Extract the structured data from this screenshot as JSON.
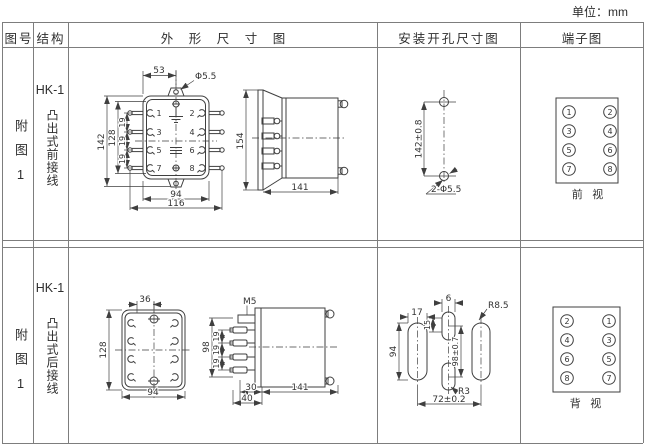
{
  "page": {
    "unit_label": "单位：mm"
  },
  "table": {
    "headers": {
      "figure": "图号",
      "structure": "结构",
      "outline": "外 形 尺 寸 图",
      "mounting": "安装开孔尺寸图",
      "terminal": "端子图"
    }
  },
  "rows": [
    {
      "figure_no": "附图1",
      "model": "HK-1",
      "wiring": "凸出式前接线",
      "front": {
        "dim_53": "53",
        "hole_label": "Φ5.5",
        "dim_142": "142",
        "dim_128": "128",
        "dim_19a": "19",
        "dim_19b": "19",
        "dim_19c": "19",
        "dim_94": "94",
        "dim_116": "116",
        "terminals": [
          "1",
          "2",
          "3",
          "4",
          "5",
          "6",
          "7",
          "8"
        ]
      },
      "side": {
        "dim_154": "154",
        "dim_141": "141"
      },
      "mounting": {
        "dim_height": "142±0.8",
        "holes_label": "2-Φ5.5"
      },
      "terminal_diagram": {
        "left": [
          "1",
          "3",
          "5",
          "7"
        ],
        "right": [
          "2",
          "4",
          "6",
          "8"
        ],
        "caption": "前 视"
      }
    },
    {
      "figure_no": "附图1",
      "model": "HK-1",
      "wiring": "凸出式后接线",
      "front": {
        "dim_36": "36",
        "dim_128": "128",
        "dim_94": "94"
      },
      "side": {
        "screw_label": "M5",
        "dim_98": "98",
        "dim_19a": "19",
        "dim_19b": "19",
        "dim_19c": "19",
        "dim_30": "30",
        "dim_40": "40",
        "dim_141": "141"
      },
      "mounting": {
        "dim_6": "6",
        "dim_17": "17",
        "dim_15": "15",
        "dim_94": "94",
        "dim_height": "98±0.7",
        "radius_large": "R8.5",
        "radius_small": "R3",
        "dim_width": "72±0.2"
      },
      "terminal_diagram": {
        "left": [
          "2",
          "4",
          "6",
          "8"
        ],
        "right": [
          "1",
          "3",
          "5",
          "7"
        ],
        "caption": "背 视"
      }
    }
  ]
}
